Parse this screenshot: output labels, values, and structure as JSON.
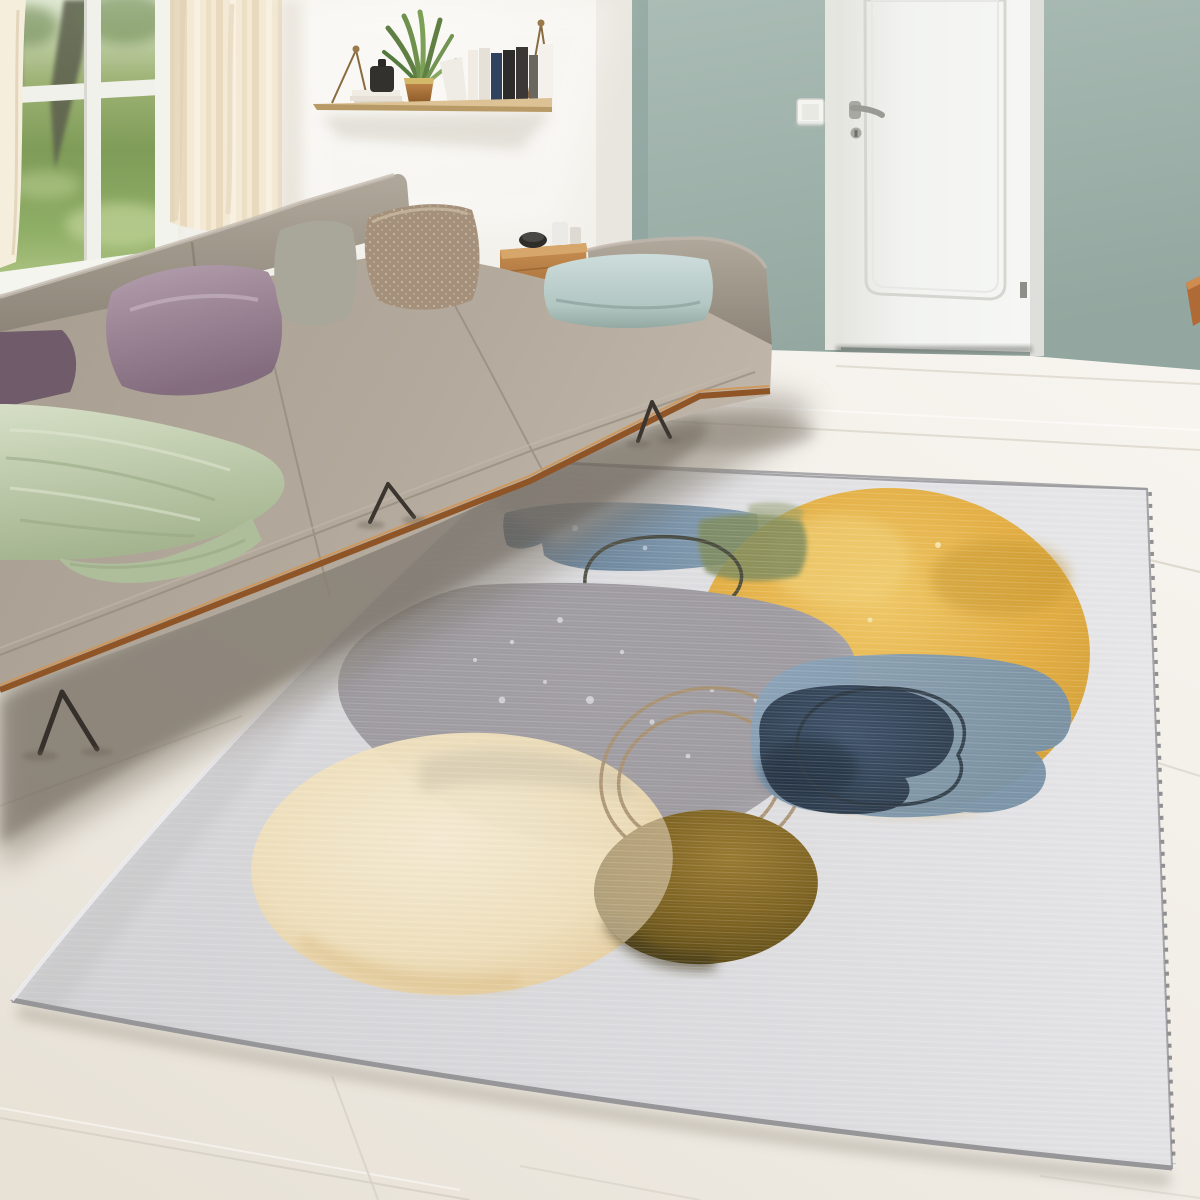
{
  "meta": {
    "width": 1200,
    "height": 1200,
    "scene": "bright living room with gray sectional sofa, teal accent wall, white interior door and abstract watercolor area rug on whitewashed plank floor"
  },
  "palette": {
    "wall_white": "#f1efe9",
    "wall_teal_top": "#aabcb5",
    "wall_teal_bottom": "#93a7a0",
    "corner_strip": "#e9e6df",
    "door_white": "#f2f3f0",
    "door_frame": "#e6e6e1",
    "door_hardware": "#9a9a94",
    "switch_plate": "#f4f4f1",
    "floor_bright": "#f5f2ec",
    "floor_warm": "#eae4da",
    "floor_seam": "#d8d2c7",
    "shadow_soft": "#7d7468",
    "shadow_core": "#5f574c",
    "curtain": "#f3e9d4",
    "curtain_fold": "#e4d5b9",
    "window_grass": "#84a35c",
    "window_haze": "#dfe8d2",
    "tree_trunk": "#5c5f4e",
    "shelf_wood": "#dcc294",
    "hanger_brass": "#8a6a3f",
    "book_white": "#f0ece4",
    "book_navy": "#31425e",
    "book_black": "#2e2c2a",
    "book_gray": "#6b665e",
    "canister_black": "#33312e",
    "plant_green": "#5f7f43",
    "plant_green_light": "#7da058",
    "pot_gold": "#c8a049",
    "sofa_fabric": "#aba197",
    "sofa_back": "#9a9185",
    "wood_rim": "#8f5526",
    "wood_rim_light": "#d09657",
    "leg_metal": "#35302b",
    "pillow_plum": "#6f5b69",
    "pillow_mauve": "#a38c9c",
    "pillow_sage": "#a9a79a",
    "pillow_beige": "#a5917b",
    "pillow_beige_dot": "#cdbfa8",
    "pillow_blue": "#c3d6d6",
    "throw_green": "#c6d1b4",
    "table_wood": "#b57c3f",
    "bowl_black": "#2e2d2a",
    "cup_white": "#eceae6",
    "chair_wood": "#b06a35",
    "rug_base_left": "#d2d2d5",
    "rug_base_right": "#e6e6e8",
    "rug_edge": "#9b9b9f",
    "rug_stitch": "#6f6f73",
    "art_blue_stroke": "#5a7690",
    "art_blue_stroke_light": "#7e99ae",
    "art_olive_overlap": "#7e8b5c",
    "art_yellow": "#e3ad41",
    "art_yellow_light": "#efc765",
    "art_yellow_deep": "#c2932c",
    "art_gray": "#9d9aa0",
    "art_gray_edge": "#b7b4b8",
    "art_slate": "#8099b0",
    "art_navy": "#32465c",
    "art_navy_deep": "#1f2a38",
    "art_cream": "#efdfba",
    "art_cream_edge": "#e2c693",
    "art_olive": "#7b601f",
    "art_olive_dark": "#4e4118",
    "art_cream_over_olive": "#c4b391",
    "ring_dark": "#44453a",
    "ring_tan": "#a8906f",
    "ring_charcoal": "#2c3844",
    "speckle": "#d9d7da"
  },
  "scene": {
    "objects": [
      {
        "name": "window-garden-view",
        "desc": "white framed window showing lawn and trees"
      },
      {
        "name": "sheer-curtain",
        "desc": "cream sheer curtain"
      },
      {
        "name": "wall-shelf",
        "desc": "hanging wood shelf with books, plant in gold pot, black canister"
      },
      {
        "name": "teal-accent-wall",
        "desc": "sage-teal painted wall section"
      },
      {
        "name": "interior-door",
        "desc": "white paneled door with lever handle"
      },
      {
        "name": "light-switch",
        "desc": "square white switch left of door"
      },
      {
        "name": "wooden-chair-edge",
        "desc": "wood furniture edge entering right frame"
      },
      {
        "name": "sectional-sofa",
        "desc": "greige L-shaped sofa on wood trim and metal legs"
      },
      {
        "name": "pillows",
        "desc": "plum, mauve, sage, beige-dotted and light-blue cushions"
      },
      {
        "name": "knit-throw",
        "desc": "sage green knit blanket"
      },
      {
        "name": "side-table",
        "desc": "wood drum table with bowl and cups"
      },
      {
        "name": "whitewashed-floor",
        "desc": "pale wide plank floor"
      },
      {
        "name": "area-rug",
        "desc": "light gray rug with abstract watercolor circles"
      },
      {
        "name": "rug-art",
        "desc": "yellow circle, blue brush stroke, gray blob, slate/navy blob, cream circle, olive circle, outline rings"
      }
    ]
  }
}
